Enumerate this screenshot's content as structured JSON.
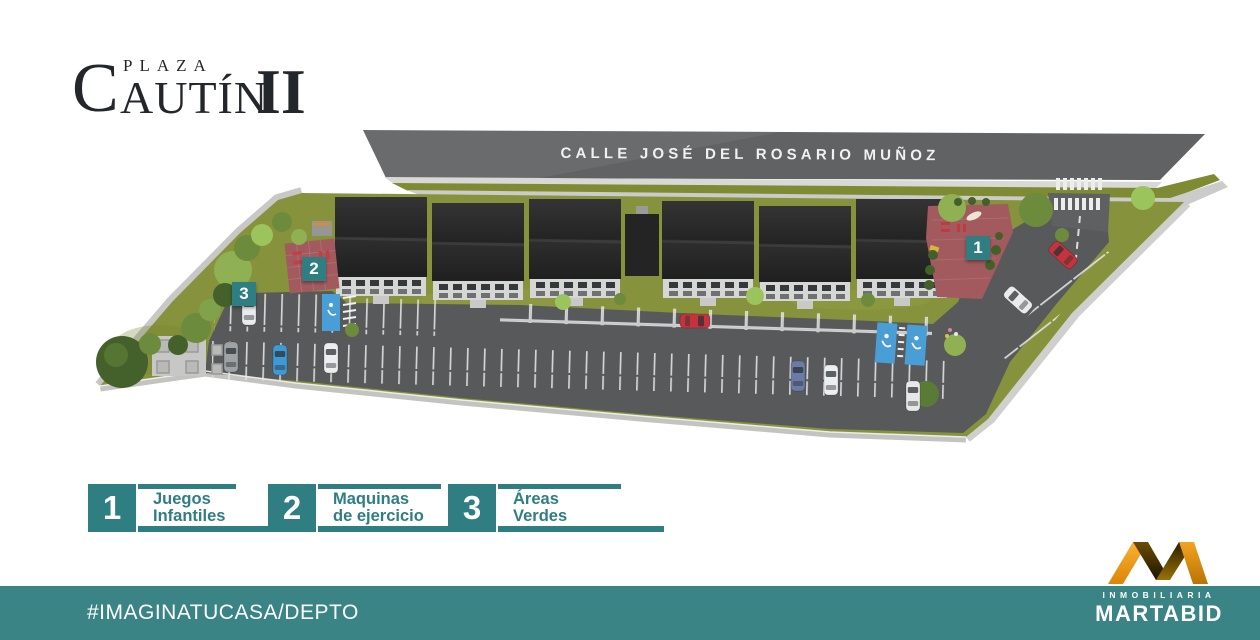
{
  "brand": {
    "small_word": "PLAZA",
    "initial": "C",
    "rest": "AUTÍN",
    "numeral": "II"
  },
  "site_plan": {
    "street_label": "CALLE JOSÉ DEL ROSARIO MUÑOZ",
    "markers": [
      {
        "number": "1"
      },
      {
        "number": "2"
      },
      {
        "number": "3"
      }
    ]
  },
  "legend": {
    "items": [
      {
        "number": "1",
        "line1": "Juegos",
        "line2": "Infantiles"
      },
      {
        "number": "2",
        "line1": "Maquinas",
        "line2": "de ejercicio"
      },
      {
        "number": "3",
        "line1": "Áreas",
        "line2": "Verdes"
      }
    ]
  },
  "footer": {
    "hashtag": "#IMAGINATUCASA/DEPTO"
  },
  "developer": {
    "subtitle": "INMOBILIARIA",
    "name": "MARTABID"
  },
  "colors": {
    "teal": "#2f7e82",
    "footer_teal": "#3a8486",
    "logo_orange": "#ee9a12",
    "ink": "#23272b",
    "grass": "#87923c",
    "asphalt": "#58595b",
    "road": "#606264",
    "play_area_red": "#a25a5e",
    "handicap_blue": "#4a9ed6"
  }
}
